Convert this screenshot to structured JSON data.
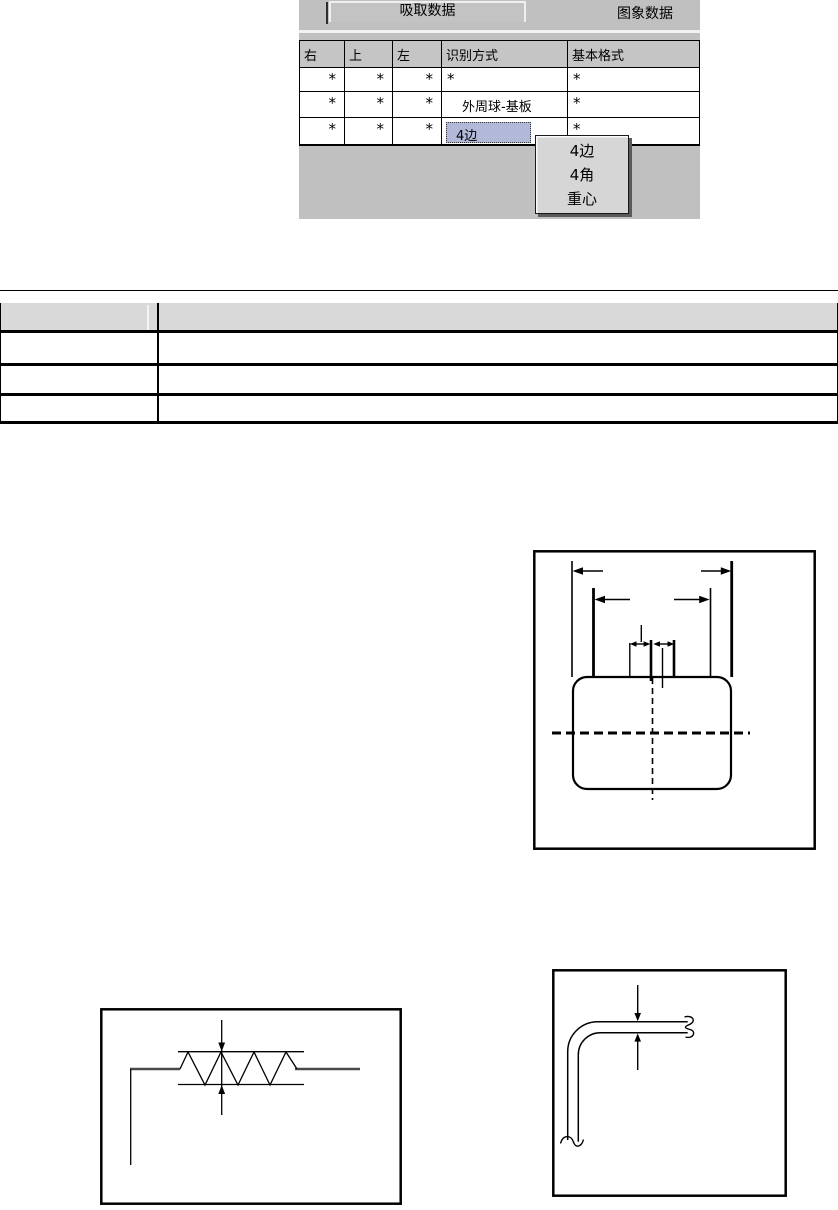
{
  "screenshot": {
    "tab_active": "吸取数据",
    "tab_inactive": "图象数据",
    "grid": {
      "headers": [
        "右",
        "上",
        "左",
        "识别方式",
        "基本格式"
      ],
      "rows": [
        [
          "*",
          "*",
          "*",
          "*",
          "*"
        ],
        [
          "*",
          "*",
          "*",
          "外周球-基板",
          "*"
        ],
        [
          "*",
          "*",
          "*",
          "4边",
          "*"
        ]
      ]
    },
    "dropdown": {
      "items": [
        "4边",
        "4角",
        "重心"
      ]
    },
    "colors": {
      "chrome": "#c0c0c0",
      "selected_cell": "#b2b8d8",
      "dropdown_bg": "#d6d6d6"
    }
  },
  "summary_table": {
    "header_fill": "#d9d9d9",
    "row_count": 3,
    "cells": [
      [
        "",
        ""
      ],
      [
        "",
        ""
      ],
      [
        "",
        ""
      ]
    ]
  }
}
